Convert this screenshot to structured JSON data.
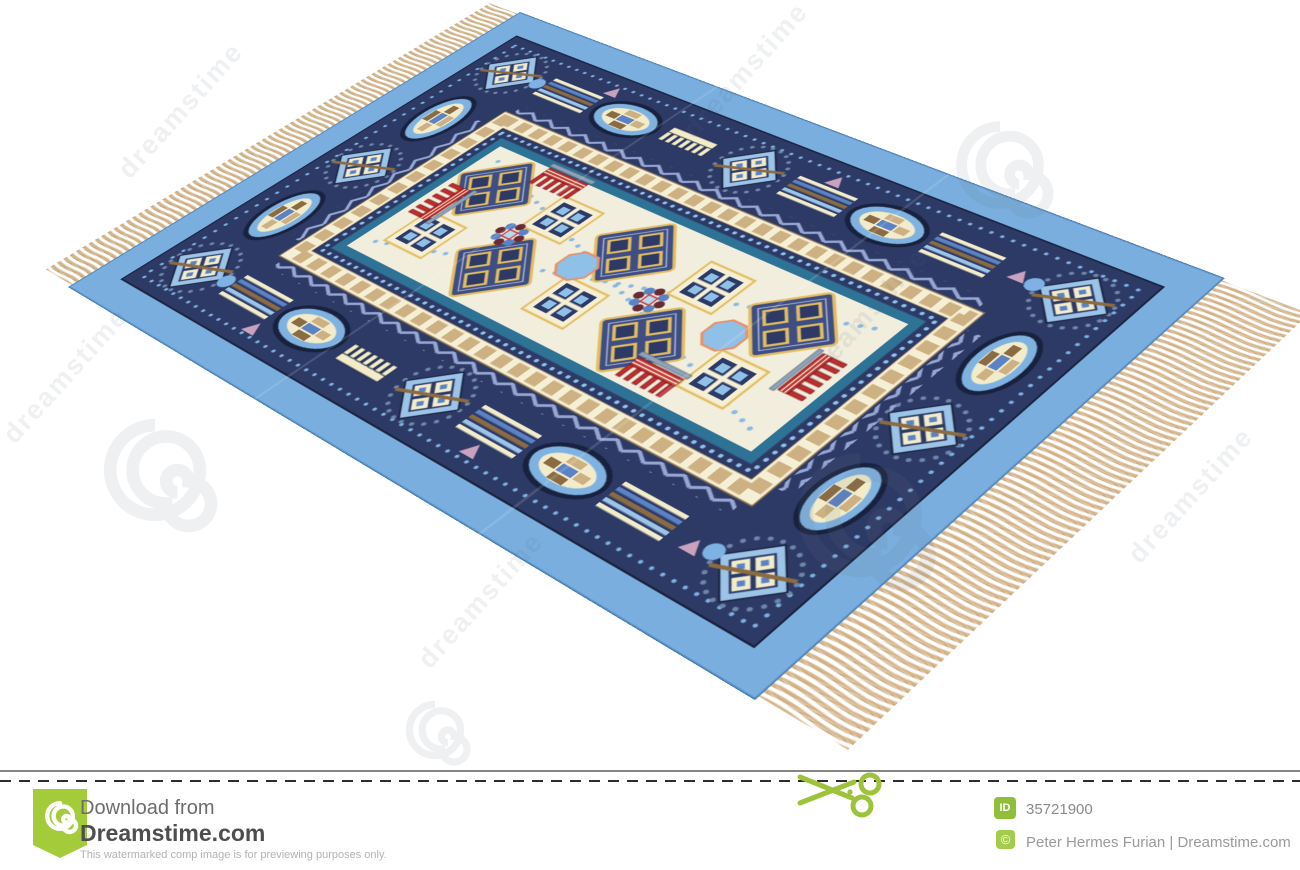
{
  "watermark": {
    "brand": "dreamstime"
  },
  "footer": {
    "download_from": "Download from",
    "brand": "Dreamstime.com",
    "tagline": "This watermarked comp image is for previewing purposes only.",
    "id_label": "ID",
    "id_value": "35721900",
    "copyright_symbol": "©",
    "credit": "Peter Hermes Furian | Dreamstime.com"
  },
  "colors": {
    "dreamstime_green": "#a3cb3a",
    "carpet_outer_border": "#79aede",
    "carpet_band_navy": "#2d3a66",
    "carpet_field_ivory": "#f2eedd",
    "carpet_frame_teal": "#2e7296",
    "carpet_checker_tan": "#cdb183",
    "carpet_accent_red": "#bf2e2e",
    "carpet_accent_gold": "#e3bd62",
    "carpet_fringe_tan": "#d2b184",
    "footer_text_gray": "#6b6c6e"
  }
}
